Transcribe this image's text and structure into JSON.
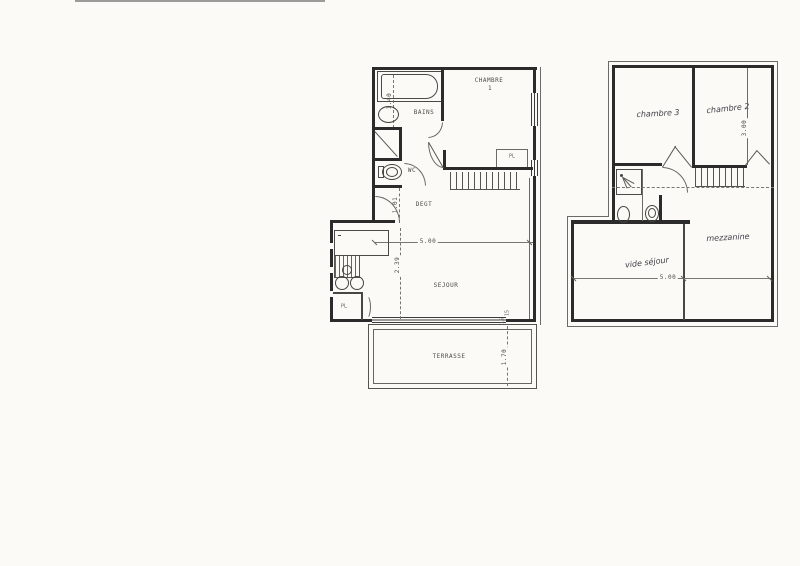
{
  "plans": {
    "ground_floor": {
      "labels": {
        "bains": "BAINS",
        "chambre": "CHAMBRE",
        "chambre_num": "1",
        "wc": "WC",
        "degt": "DEGT",
        "sejour": "SEJOUR",
        "terrasse": "TERRASSE",
        "pl_chambre": "PL",
        "pl_cuisine": "PL"
      },
      "dimensions": {
        "bain_length": "1.40",
        "degt_depth": "1.01",
        "sejour_width": "5.00",
        "sejour_depth": "2.39",
        "terrasse_depth": "1.70",
        "window_mark_a": "15",
        "window_mark_b": "15"
      }
    },
    "upper_floor": {
      "labels": {
        "chambre3": "chambre 3",
        "chambre2": "chambre 2",
        "mezzanine": "mezzanine",
        "vide_sejour": "vide séjour"
      },
      "dimensions": {
        "chambre2_depth": "3.00",
        "floor_width": "5.00"
      }
    }
  },
  "colors": {
    "paper": "#fbfaf6",
    "wall_ink": "#2b2b2b",
    "line_ink": "#5a5a54",
    "pencil": "#3d3d45",
    "scan_artifact": "#9b9b99"
  }
}
